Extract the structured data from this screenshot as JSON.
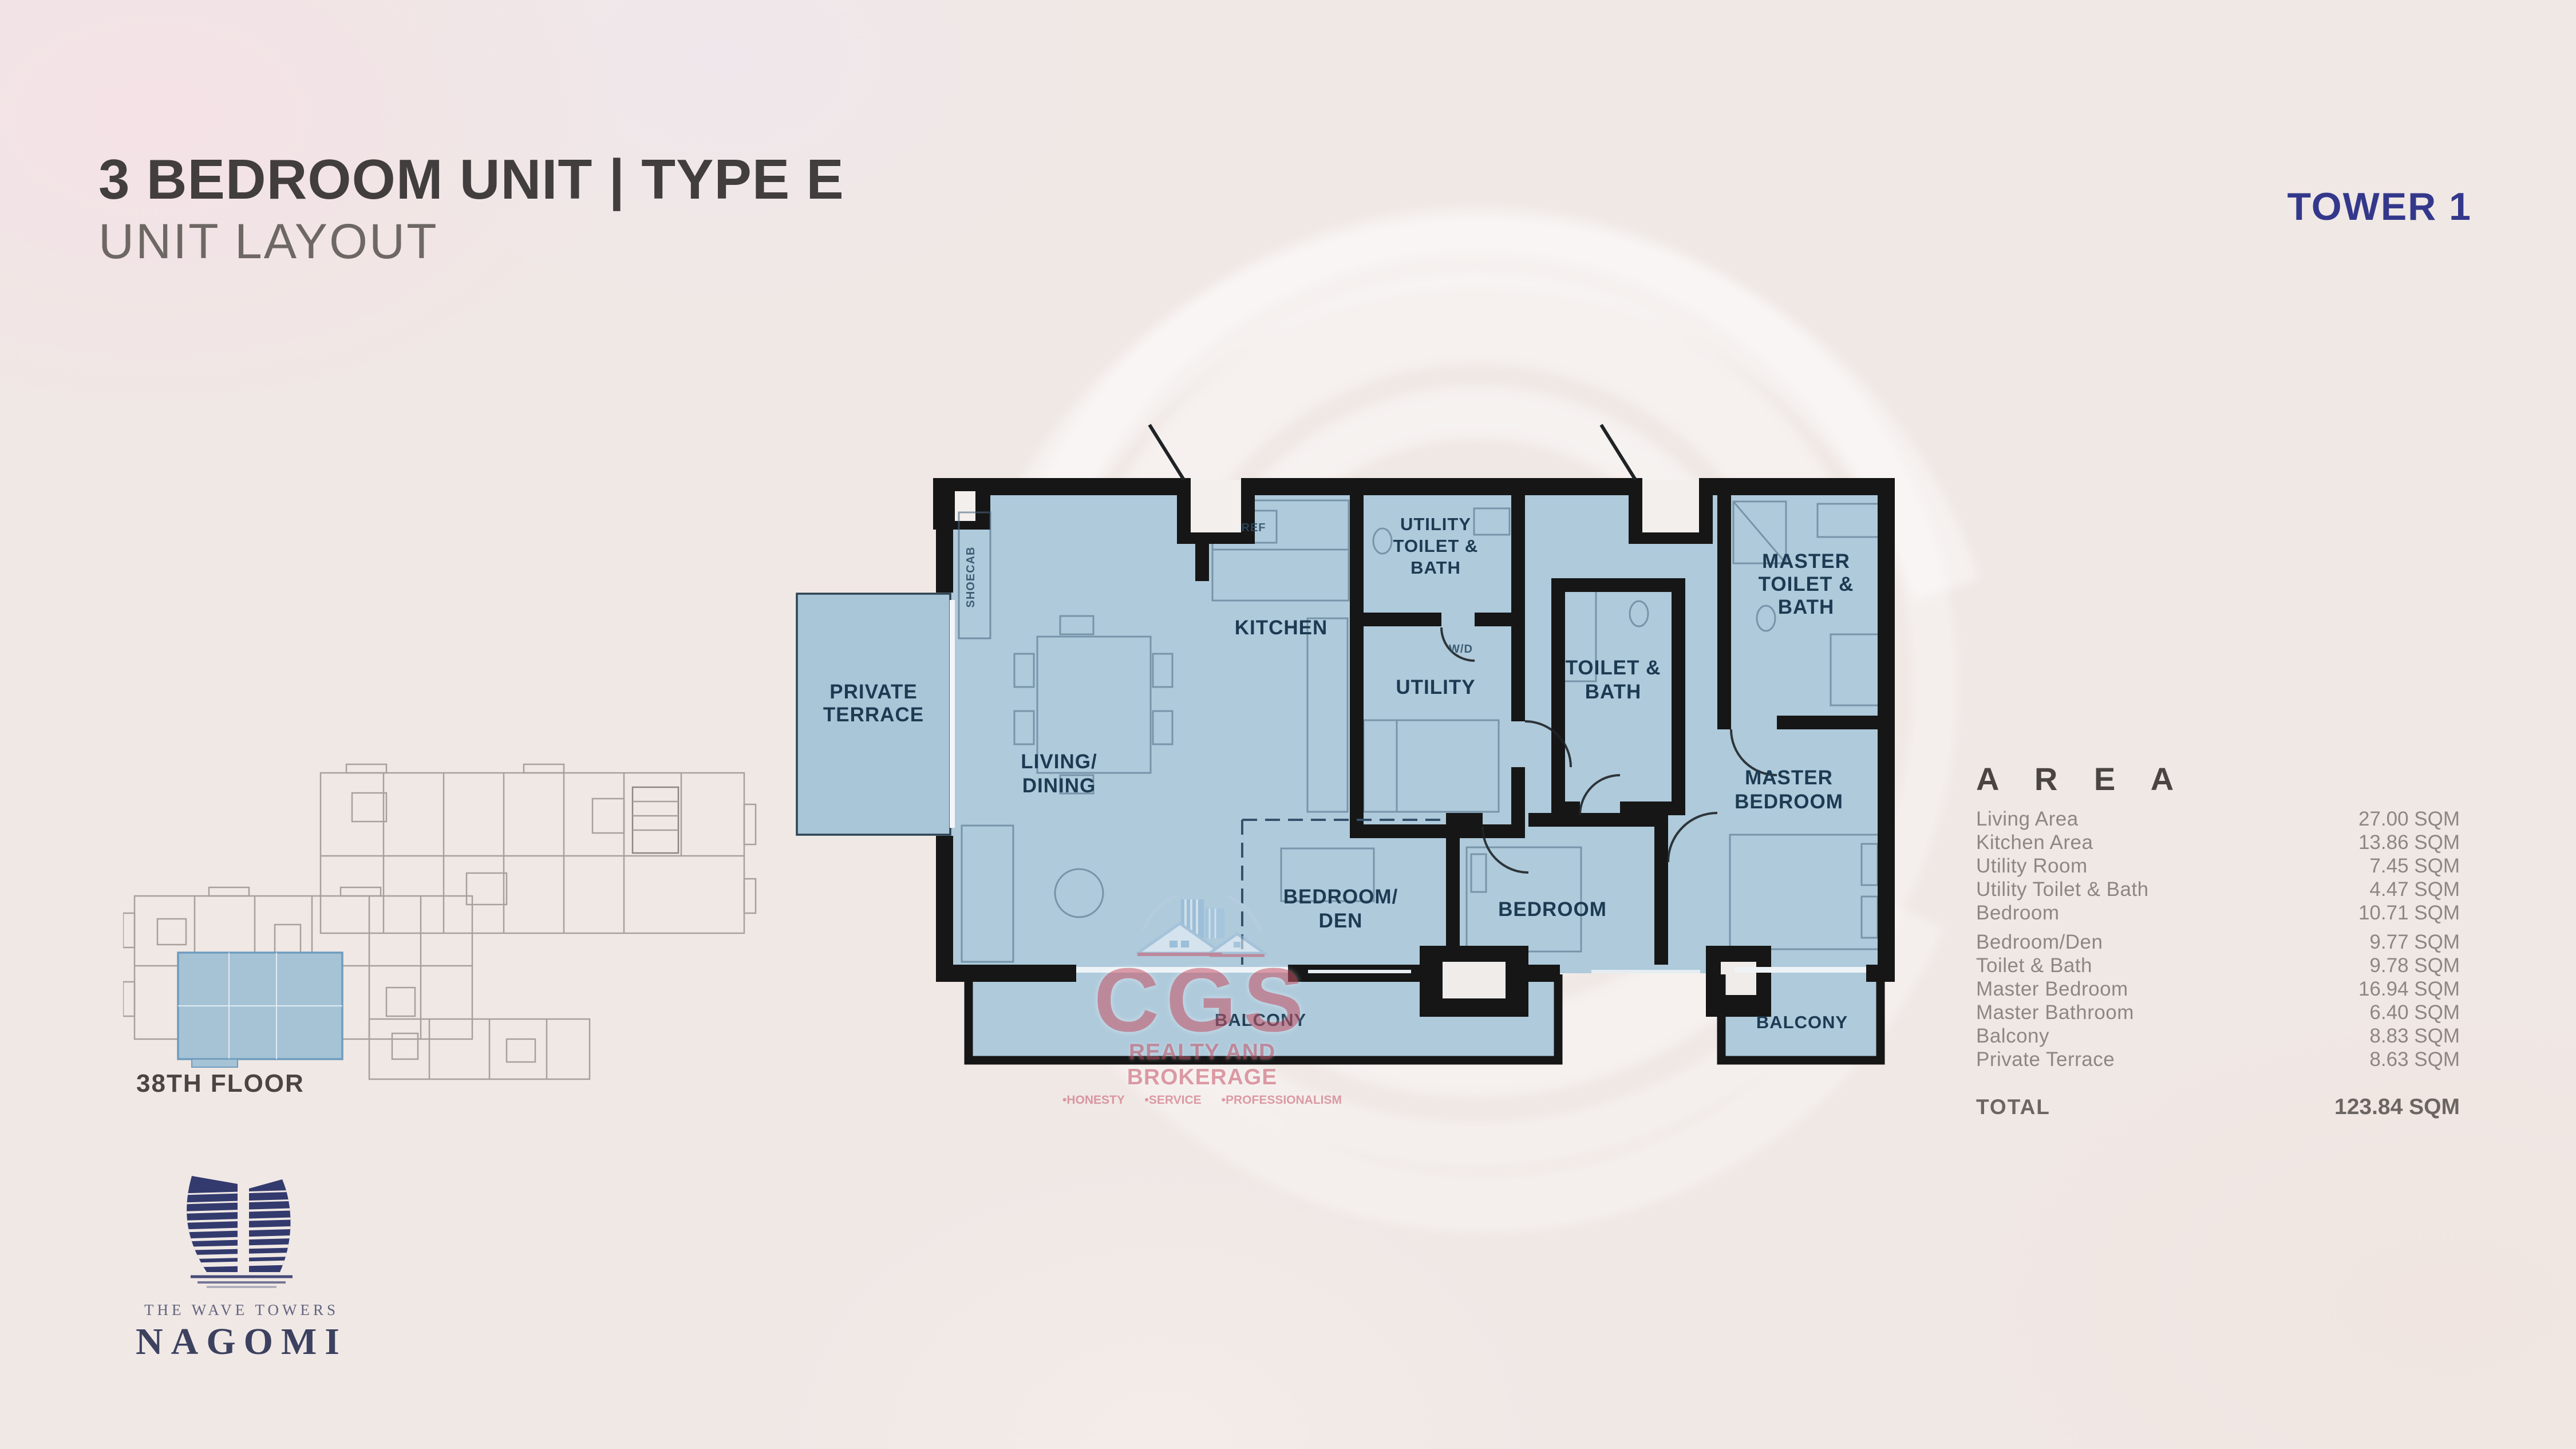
{
  "header": {
    "title": "3 BEDROOM UNIT | TYPE E",
    "subtitle": "UNIT LAYOUT",
    "tower_label": "TOWER 1"
  },
  "key_plan": {
    "floor_label": "38TH FLOOR"
  },
  "floor_plan": {
    "rooms": [
      {
        "id": "private-terrace",
        "lines": [
          "PRIVATE",
          "TERRACE"
        ]
      },
      {
        "id": "living-dining",
        "lines": [
          "LIVING/",
          "DINING"
        ]
      },
      {
        "id": "kitchen",
        "lines": [
          "KITCHEN"
        ]
      },
      {
        "id": "utility",
        "lines": [
          "UTILITY"
        ]
      },
      {
        "id": "utility-toilet-bath",
        "lines": [
          "UTILITY",
          "TOILET &",
          "BATH"
        ]
      },
      {
        "id": "toilet-bath",
        "lines": [
          "TOILET &",
          "BATH"
        ]
      },
      {
        "id": "master-toilet-bath",
        "lines": [
          "MASTER",
          "TOILET &",
          "BATH"
        ]
      },
      {
        "id": "master-bedroom",
        "lines": [
          "MASTER",
          "BEDROOM"
        ]
      },
      {
        "id": "bedroom-den",
        "lines": [
          "BEDROOM/",
          "DEN"
        ]
      },
      {
        "id": "bedroom",
        "lines": [
          "BEDROOM"
        ]
      },
      {
        "id": "balcony-main",
        "lines": [
          "BALCONY"
        ]
      },
      {
        "id": "balcony-master",
        "lines": [
          "BALCONY"
        ]
      }
    ],
    "fixtures": {
      "ref": "REF",
      "washer_dryer": "W/D",
      "shoe_cabinet": "SHOECAB"
    }
  },
  "area_table": {
    "heading": "A R E A",
    "rows": [
      {
        "label": "Living Area",
        "value": "27.00 SQM"
      },
      {
        "label": "Kitchen Area",
        "value": "13.86 SQM"
      },
      {
        "label": "Utility Room",
        "value": "7.45 SQM"
      },
      {
        "label": "Utility Toilet & Bath",
        "value": "4.47 SQM"
      },
      {
        "label": "Bedroom",
        "value": "10.71 SQM"
      },
      {
        "label": "Bedroom/Den",
        "value": "9.77 SQM"
      },
      {
        "label": "Toilet & Bath",
        "value": "9.78 SQM"
      },
      {
        "label": "Master Bedroom",
        "value": "16.94 SQM"
      },
      {
        "label": "Master Bathroom",
        "value": "6.40 SQM"
      },
      {
        "label": "Balcony",
        "value": "8.83 SQM"
      },
      {
        "label": "Private Terrace",
        "value": "8.63 SQM"
      }
    ],
    "total": {
      "label": "TOTAL",
      "value": "123.84 SQM"
    }
  },
  "watermark": {
    "initials": "CGS",
    "subtitle": "REALTY AND BROKERAGE",
    "tagline": "•HONESTY      •SERVICE      •PROFESSIONALISM"
  },
  "logo": {
    "brand": "THE WAVE TOWERS",
    "name": "NAGOMI"
  },
  "colors": {
    "background": "#f0e8e5",
    "plan_fill": "#aecadb",
    "wall": "#161616",
    "room_label": "#1d3a53",
    "tower_navy": "#34388b",
    "title_gray": "#423e3d",
    "table_gray": "#8d8784",
    "watermark_red": "#c85468",
    "logo_navy": "#333a6d",
    "keyplan_highlight": "#a6c3d6"
  }
}
